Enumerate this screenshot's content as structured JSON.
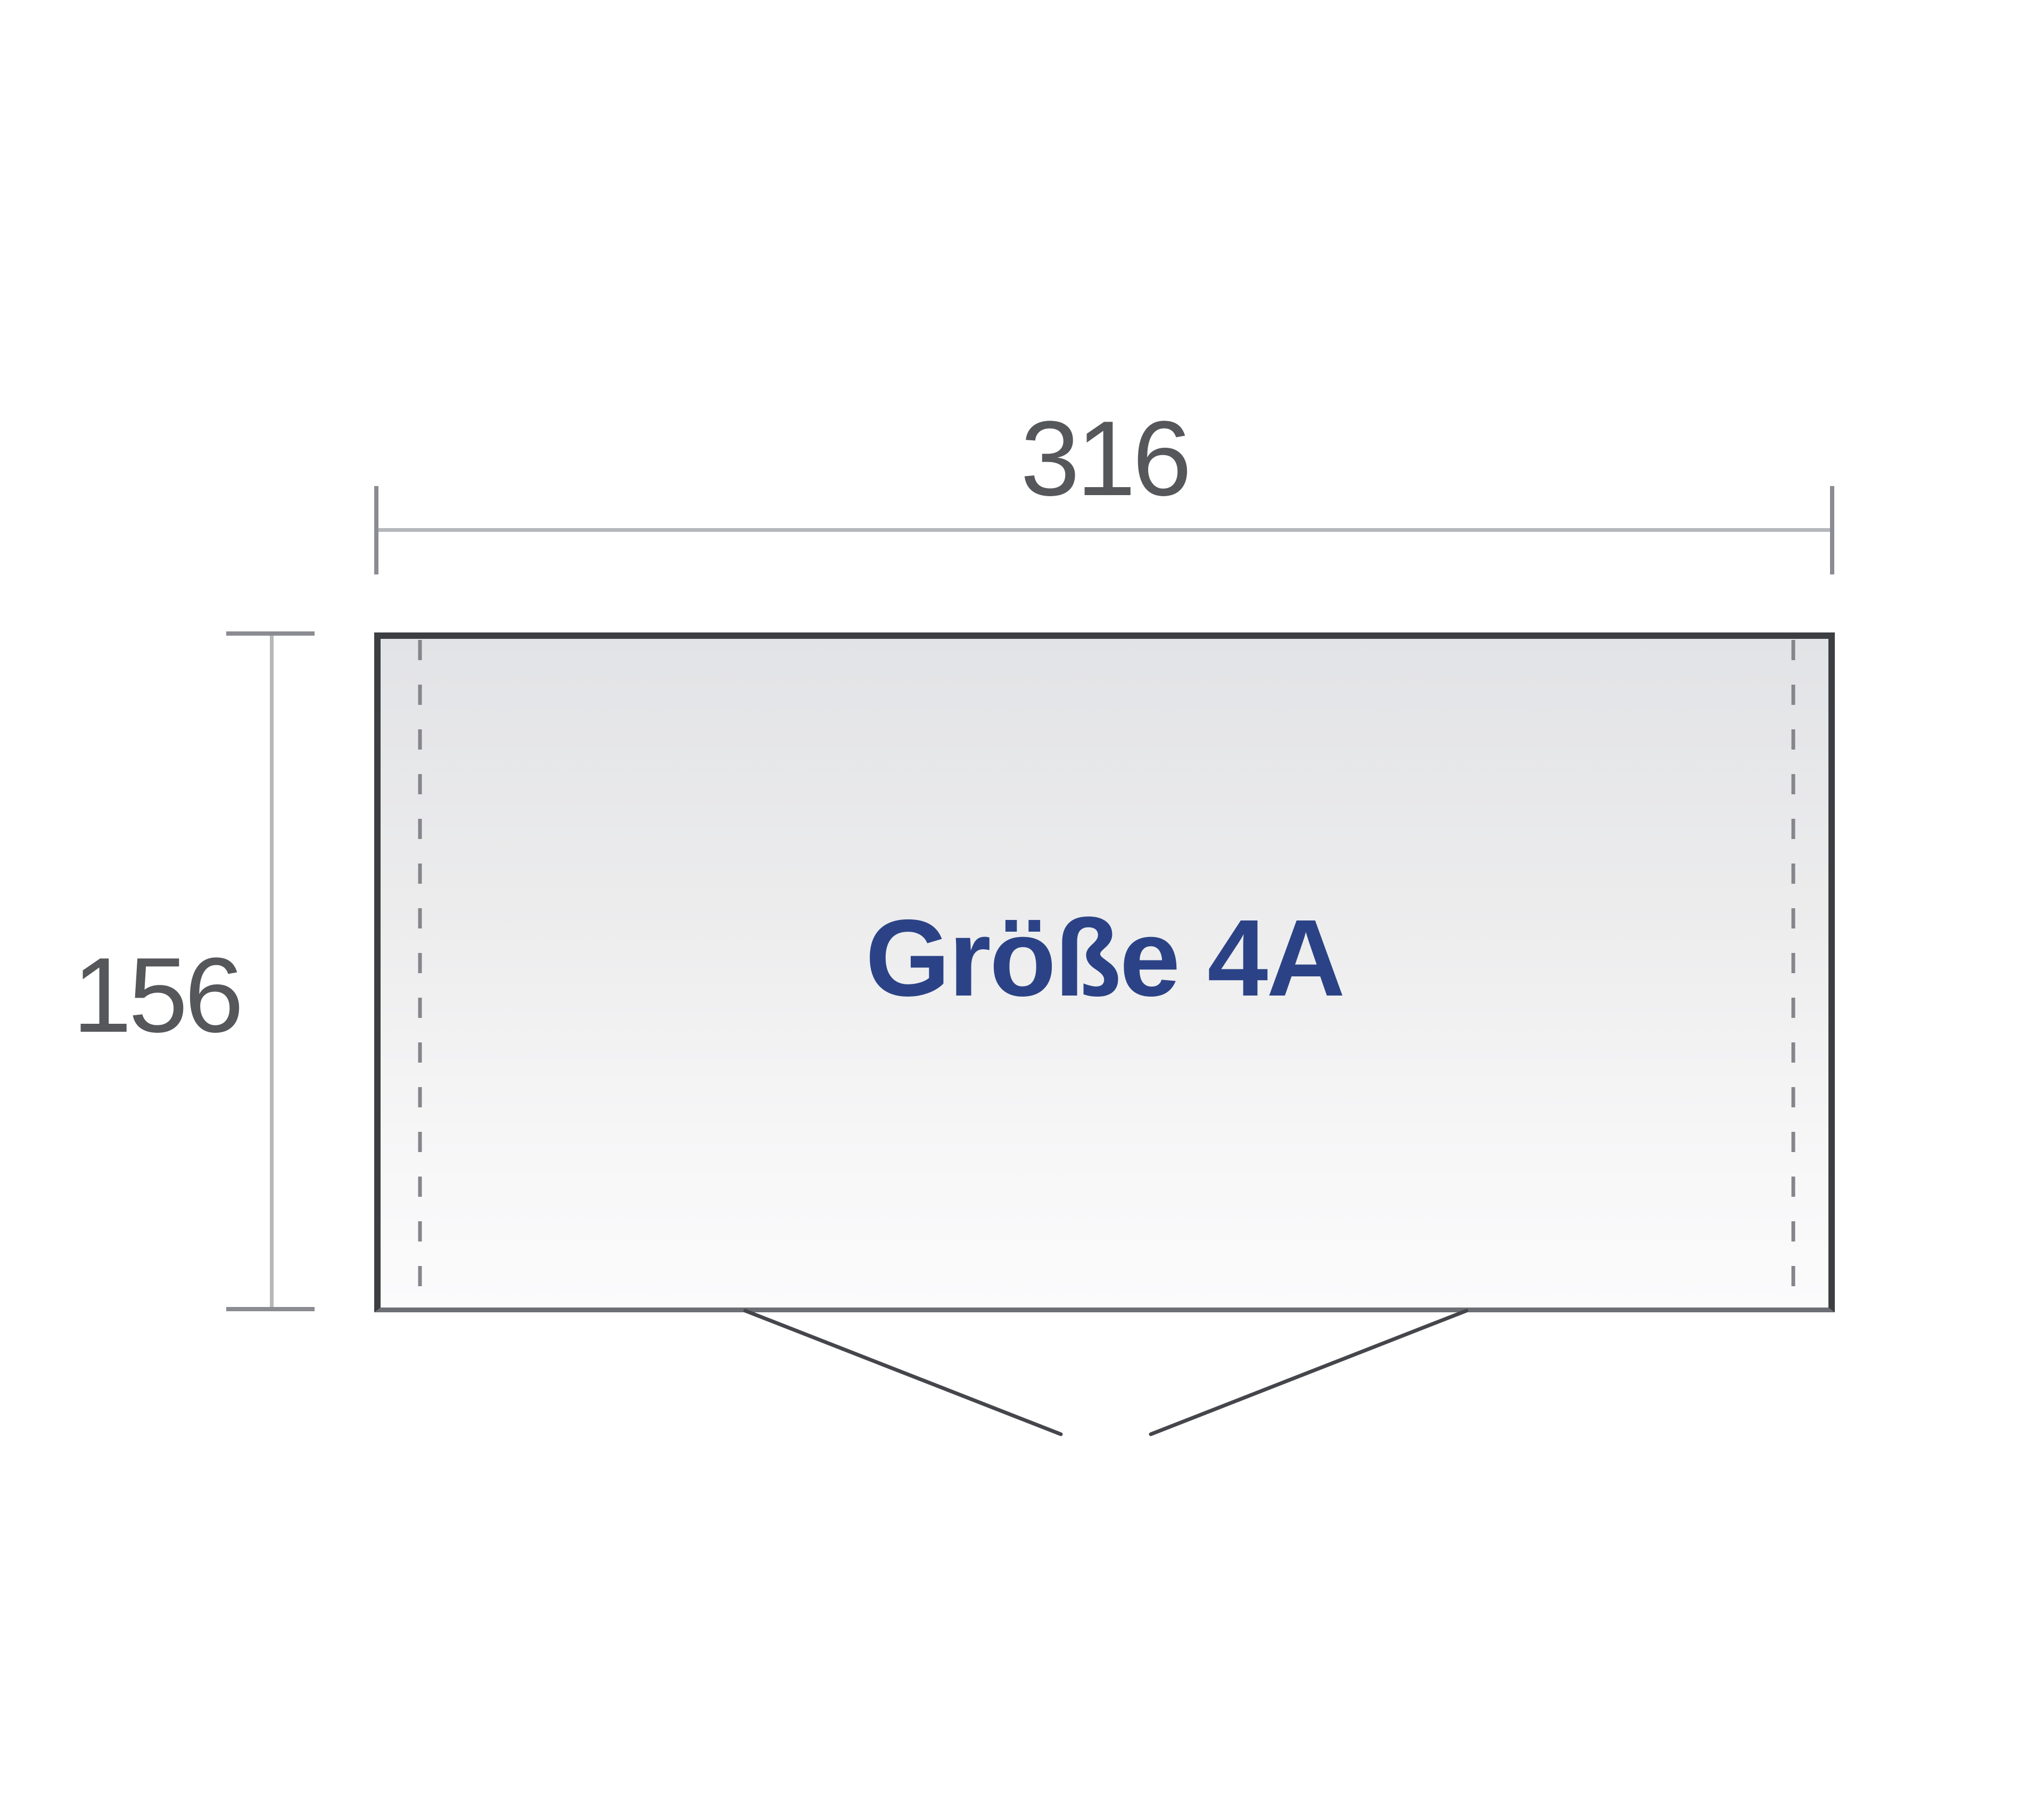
{
  "diagram": {
    "product_label": "Größe 4A",
    "width_dimension": "316",
    "depth_dimension": "156",
    "colors": {
      "label_text": "#2b4386",
      "dimension_text": "#56575a",
      "wall": "#3d3e42",
      "front_wall": "#6e6f75",
      "dimension_line": "#b6b7bb",
      "dimension_tick": "#8b8c91",
      "dashed_line": "#85868b",
      "door_swing": "#45464b",
      "floor_top": "#e2e3e6",
      "floor_bottom": "#fbfbfc"
    }
  }
}
